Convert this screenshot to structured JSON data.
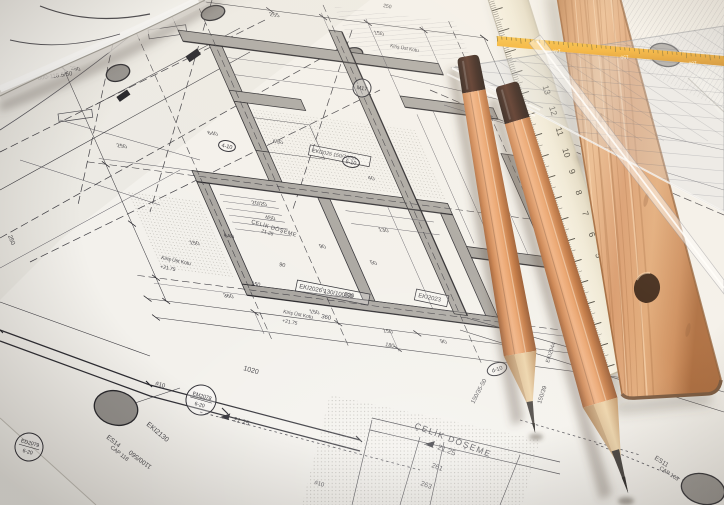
{
  "scene_title": "architectural blueprint with pencils, rulers and set square",
  "colors": {
    "paper": "#f3f1ec",
    "ink": "#2b2a30",
    "wall_grey": "#a8a5a0",
    "pencil_wood": "#d98e5a",
    "pencil_cap": "#2a140c",
    "graphite": "#35302c",
    "ivory_ruler": "#f0ebdb",
    "wood_ruler": "#d69464",
    "yellow_stripe": "#f2a71c"
  },
  "white_ruler": {
    "numbers": [
      "0",
      "1",
      "2",
      "3",
      "4",
      "5",
      "6",
      "7",
      "8",
      "9",
      "10",
      "11",
      "12",
      "13"
    ]
  },
  "set_square": {
    "scale_numbers": [
      "140",
      "150",
      "160"
    ]
  },
  "plan": {
    "labels": [
      {
        "t": "ÇELİK DÖŞEME",
        "x": 414,
        "y": 428,
        "r": 21,
        "s": 8.5,
        "sp": 1.5
      },
      {
        "t": "21.25",
        "x": 437,
        "y": 449,
        "r": 21,
        "s": 7.5,
        "lvl": true
      },
      {
        "t": "261",
        "x": 431,
        "y": 467,
        "r": 21,
        "s": 7
      },
      {
        "t": "263",
        "x": 420,
        "y": 485,
        "r": 21,
        "s": 7
      },
      {
        "t": "ÇELİK DÖŞEME",
        "x": 251,
        "y": 223,
        "r": 17,
        "s": 5.5,
        "sp": 0.5
      },
      {
        "t": "21.25",
        "x": 261,
        "y": 232,
        "r": 17,
        "s": 5
      },
      {
        "t": "EKI2130",
        "x": 146,
        "y": 425,
        "r": 40,
        "s": 7
      },
      {
        "t": "ES14",
        "x": 106,
        "y": 438,
        "r": 38,
        "s": 6.5
      },
      {
        "t": "CAP 118",
        "x": 110,
        "y": 448,
        "r": 38,
        "s": 5.5
      },
      {
        "t": "1100/560",
        "x": 152,
        "y": 466,
        "r": 217,
        "s": 6.5
      },
      {
        "t": "1020",
        "x": 243,
        "y": 370,
        "r": 16,
        "s": 7
      },
      {
        "t": "#10",
        "x": 155,
        "y": 385,
        "r": 16,
        "s": 6
      },
      {
        "t": "#10",
        "x": 314,
        "y": 484,
        "r": 16,
        "s": 6
      },
      {
        "t": "21.25",
        "x": 233,
        "y": 421,
        "r": 16,
        "s": 6.5,
        "lvl": true
      },
      {
        "t": "EKI2026 130/100/50",
        "x": 299,
        "y": 288,
        "r": 11,
        "s": 6,
        "box": true
      },
      {
        "t": "Kiriş Üst Kotu",
        "x": 283,
        "y": 313,
        "r": 11,
        "s": 5
      },
      {
        "t": "+21.75",
        "x": 282,
        "y": 322,
        "r": 11,
        "s": 5
      },
      {
        "t": "Kiriş Üst Kotu",
        "x": 161,
        "y": 259,
        "r": 12,
        "s": 5
      },
      {
        "t": "+21.75",
        "x": 160,
        "y": 268,
        "r": 12,
        "s": 5
      },
      {
        "t": "800-118.5/50",
        "x": 38,
        "y": 80,
        "r": -8,
        "s": 6
      },
      {
        "t": "250",
        "x": 8,
        "y": 236,
        "r": 68,
        "s": 6
      },
      {
        "t": "530",
        "x": 344,
        "y": 296,
        "r": 11,
        "s": 6
      },
      {
        "t": "360",
        "x": 321,
        "y": 318,
        "r": 11,
        "s": 6
      },
      {
        "t": "90",
        "x": 279,
        "y": 266,
        "r": 11,
        "s": 5.5
      },
      {
        "t": "150",
        "x": 251,
        "y": 285,
        "r": 11,
        "s": 5.5
      },
      {
        "t": "180",
        "x": 385,
        "y": 346,
        "r": 11,
        "s": 5.5
      },
      {
        "t": "EKI2023",
        "x": 418,
        "y": 297,
        "r": 12,
        "s": 6,
        "box": true
      },
      {
        "t": "150/35-50",
        "x": 474,
        "y": 404,
        "r": -62,
        "s": 6
      },
      {
        "t": "150/39",
        "x": 541,
        "y": 404,
        "r": -72,
        "s": 6
      },
      {
        "t": "EKI2044",
        "x": 549,
        "y": 363,
        "r": -72,
        "s": 5.5
      },
      {
        "t": "ES11",
        "x": 654,
        "y": 459,
        "r": 33,
        "s": 6.5
      },
      {
        "t": "CAP 105",
        "x": 659,
        "y": 469,
        "r": 33,
        "s": 5.5
      },
      {
        "t": "Kiriş Üst Kotu",
        "x": 390,
        "y": 47,
        "r": 10,
        "s": 4.8
      },
      {
        "t": "250",
        "x": 383,
        "y": 7,
        "r": 10,
        "s": 5
      },
      {
        "t": "EKI2025 150/70/50",
        "x": 312,
        "y": 152,
        "r": 11,
        "s": 5.2,
        "box": true
      }
    ],
    "circle_labels": [
      {
        "l1": "EM2078",
        "l2": "6-20",
        "x": 201,
        "y": 400,
        "rad": 15,
        "rot": 16
      },
      {
        "l1": "ED2079",
        "l2": "6-20",
        "x": 29,
        "y": 447,
        "rad": 14,
        "rot": 16
      },
      {
        "l1": "M17",
        "l2": "",
        "x": 362,
        "y": 88,
        "rad": 9,
        "rot": 12
      },
      {
        "l1": "d-10",
        "l2": "",
        "x": 497,
        "y": 369,
        "rad": 10,
        "rot": -18,
        "oval": true
      },
      {
        "l1": "6-10",
        "l2": "",
        "x": 351,
        "y": 162,
        "rad": 8.5,
        "rot": 12,
        "oval": true
      },
      {
        "l1": "4-10",
        "l2": "",
        "x": 227,
        "y": 146,
        "rad": 8.5,
        "rot": 12,
        "oval": true
      }
    ],
    "dims": [
      {
        "t": "20/20",
        "u": 107,
        "v": 197
      },
      {
        "t": "450",
        "u": 115,
        "v": 213
      },
      {
        "t": "640",
        "u": 59,
        "v": 242
      },
      {
        "t": "150",
        "u": 16,
        "v": 256
      },
      {
        "t": "90",
        "u": 162,
        "v": 240
      },
      {
        "t": "250",
        "u": -18,
        "v": 148
      },
      {
        "t": "50",
        "u": 212,
        "v": 252
      },
      {
        "t": "130",
        "u": 238,
        "v": 210
      },
      {
        "t": "40",
        "u": 252,
        "v": 148
      },
      {
        "t": "360",
        "u": 28,
        "v": 316
      },
      {
        "t": "150",
        "u": 118,
        "v": 322
      },
      {
        "t": "150",
        "u": 192,
        "v": 334
      },
      {
        "t": "90",
        "u": 252,
        "v": 338
      },
      {
        "t": "530",
        "u": 92,
        "v": -38
      },
      {
        "t": "255",
        "u": 222,
        "v": -38
      },
      {
        "t": "150",
        "u": 332,
        "v": -32
      },
      {
        "t": "640",
        "u": 92,
        "v": 118
      },
      {
        "t": "450",
        "u": 162,
        "v": 118
      },
      {
        "t": "250",
        "u": -32,
        "v": 60
      }
    ]
  }
}
